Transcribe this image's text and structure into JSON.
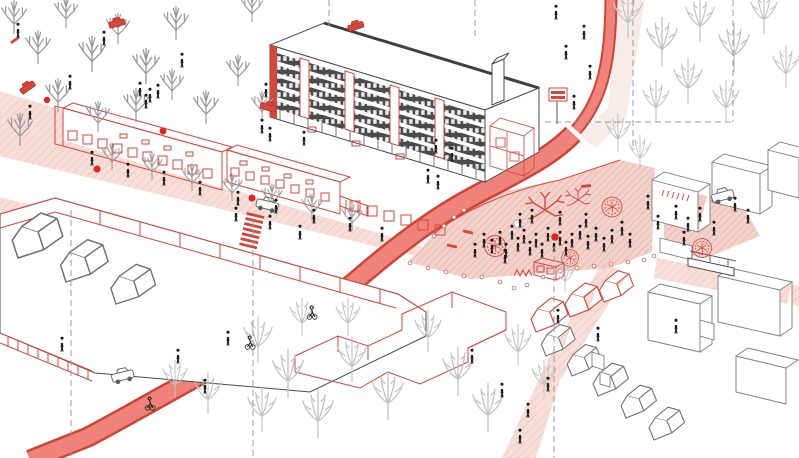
{
  "scene": {
    "aria": {
      "illustration": "Axonometric urban redesign illustration with red cycle route and pink pedestrian plaza",
      "park": "Park with bare trees and winding paths",
      "slab": "Large slab apartment block with dark window bands and red accents",
      "pavilions": "Single-storey shop pavilions with red outlines",
      "cycle_route": "Red cycle route ribbon",
      "plaza": "Pink hatched pedestrian plaza with people",
      "east_plaza": "Smaller pink plaza east of the crossing street",
      "supermarket": "Large flat-roof building outlined in red",
      "proposed": "Proposed building shown as red outline",
      "housing": "Gabled housing cluster",
      "roads": "Streets and service roads",
      "kiosk": "Red kiosk on the plaza",
      "bus_stop": "Bus stop platform",
      "trees": "Trees",
      "people": "Pedestrians and cyclists",
      "vehicles": "Cars",
      "section_lines": "Dashed section reference lines",
      "markers": "Red location marker dots"
    }
  },
  "palette": {
    "background": "#ffffff",
    "accent_red": "#d5463b",
    "marker_red": "#e0271c",
    "ribbon_fill": "#ef837a",
    "ribbon_edge": "#cf4437",
    "plaza_fill": "#f4d2cc",
    "plaza_hatch": "#e3aaa2",
    "sidewalk_fill": "#f8ded8",
    "sidewalk_hatch": "#eebbb2",
    "line_dark": "#4a4a4a",
    "line_grey": "#8a8a8a",
    "tree_grey": "#9a9a9a",
    "tree_light": "#c2c2c2",
    "people_black": "#1d1d1d",
    "facade_dark": "#4b4b4b"
  },
  "inventory": {
    "planters": 4,
    "bollards": 20,
    "cars": 7,
    "red_marker_dots": 5,
    "pedestrians": 70,
    "cyclists": 3,
    "trees": 34,
    "crossings": 1
  }
}
